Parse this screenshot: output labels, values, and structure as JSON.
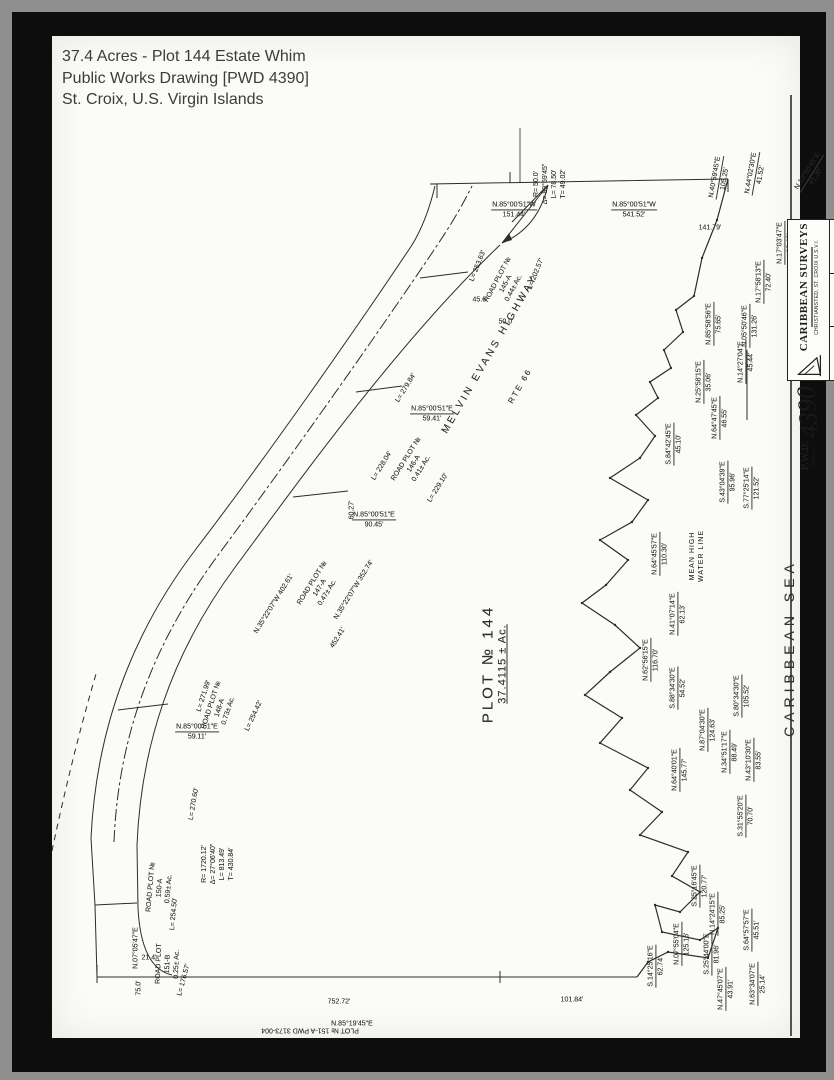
{
  "caption": {
    "line1": "37.4 Acres - Plot 144 Estate Whim",
    "line2": "Public Works Drawing [PWD 4390]",
    "line3": "St. Croix, U.S. Virgin Islands"
  },
  "plot": {
    "name": "PLOT № 144",
    "area": "37.4115 ± Ac."
  },
  "sea_label": "CARIBBEAN SEA",
  "highway": {
    "name": "MELVIN EVANS HIGHWAY",
    "route": "RTE 66"
  },
  "title_block": {
    "firm": "CARIBBEAN SURVEYS",
    "address": "CHRISTIANSTED, ST. CROIX  U.S.V.I.",
    "logo_icon": "sail-pennant-logo",
    "pwd": "P.W.D.",
    "dwg_no_label": "DWG. NO.",
    "dwg_no": "4390"
  },
  "labels": [
    {
      "t": [
        "N.85°00'51\"W",
        "151.44'"
      ],
      "x": 462,
      "y": 174,
      "r": 0,
      "u": 1
    },
    {
      "t": [
        "N.85°00'51\"W",
        "541.52'"
      ],
      "x": 582,
      "y": 174,
      "r": 0,
      "u": 1
    },
    {
      "t": [
        "141.79'"
      ],
      "x": 658,
      "y": 192,
      "r": 0
    },
    {
      "t": [
        "R= 50.0'",
        "Δ= 89°59'45\"",
        "L= 78.50'",
        "T= 49.02'"
      ],
      "x": 498,
      "y": 148,
      "r": -90
    },
    {
      "t": [
        "R= 1720.12'",
        "Δ= 27°06'40\"",
        "L= 813.49'",
        "T= 430.84'"
      ],
      "x": 166,
      "y": 828,
      "r": -90
    },
    {
      "t": [
        "N.10°50'45\"E",
        "41.30'"
      ],
      "x": 760,
      "y": 138,
      "r": -58,
      "u": 1
    },
    {
      "t": [
        "N.44°02'30\"E",
        "41.52'"
      ],
      "x": 704,
      "y": 138,
      "r": -80,
      "u": 1
    },
    {
      "t": [
        "N.40°59'45\"E",
        "105.25'"
      ],
      "x": 668,
      "y": 142,
      "r": -80,
      "u": 1
    },
    {
      "t": [
        "N.17°03'47\"E",
        "12.40'"
      ],
      "x": 733,
      "y": 207,
      "r": -90,
      "u": 1
    },
    {
      "t": [
        "N.17°58'13\"E",
        "72.40'"
      ],
      "x": 712,
      "y": 246,
      "r": -90,
      "u": 1
    },
    {
      "t": [
        "N.05°50'46\"E",
        "131.26'"
      ],
      "x": 698,
      "y": 290,
      "r": -90,
      "u": 1
    },
    {
      "t": [
        "N.85°58'56\"E",
        "75.65'"
      ],
      "x": 662,
      "y": 288,
      "r": -90,
      "u": 1
    },
    {
      "t": [
        "N.14°27'04\"E",
        "45.44'"
      ],
      "x": 694,
      "y": 326,
      "r": -90,
      "u": 1
    },
    {
      "t": [
        "N.25°58'15\"E",
        "35.06'"
      ],
      "x": 652,
      "y": 346,
      "r": -90,
      "u": 1
    },
    {
      "t": [
        "N.64°47'45\"E",
        "46.55'"
      ],
      "x": 668,
      "y": 382,
      "r": -90,
      "u": 1
    },
    {
      "t": [
        "S.84°42'45\"E",
        "45.10'"
      ],
      "x": 622,
      "y": 408,
      "r": -90,
      "u": 1
    },
    {
      "t": [
        "S.43°04'39\"E",
        "95.96'"
      ],
      "x": 676,
      "y": 446,
      "r": -90,
      "u": 1
    },
    {
      "t": [
        "S.77°25'14\"E",
        "121.52'"
      ],
      "x": 700,
      "y": 452,
      "r": -90,
      "u": 1
    },
    {
      "t": [
        "N.64°45'57\"E",
        "110.30'"
      ],
      "x": 608,
      "y": 518,
      "r": -90,
      "u": 1
    },
    {
      "t": [
        "MEAN HIGH",
        "WATER LINE"
      ],
      "x": 645,
      "y": 520,
      "r": -90,
      "ws": 1
    },
    {
      "t": [
        "N.41°07'14\"E",
        "62.13'"
      ],
      "x": 626,
      "y": 578,
      "r": -90,
      "u": 1
    },
    {
      "t": [
        "N.62°56'15\"E",
        "116.70'"
      ],
      "x": 599,
      "y": 624,
      "r": -90,
      "u": 1
    },
    {
      "t": [
        "S.88°34'30\"E",
        "54.52'"
      ],
      "x": 626,
      "y": 652,
      "r": -90,
      "u": 1
    },
    {
      "t": [
        "S.80°34'30\"E",
        "105.52'"
      ],
      "x": 690,
      "y": 660,
      "r": -90,
      "u": 1
    },
    {
      "t": [
        "N.87°04'30\"E",
        "124.63'"
      ],
      "x": 656,
      "y": 694,
      "r": -90,
      "u": 1
    },
    {
      "t": [
        "N.34°51'17\"E",
        "88.49'"
      ],
      "x": 678,
      "y": 716,
      "r": -90,
      "u": 1
    },
    {
      "t": [
        "N.64°40'01\"E",
        "145.77'"
      ],
      "x": 628,
      "y": 734,
      "r": -90,
      "u": 1
    },
    {
      "t": [
        "N.43°10'30\"E",
        "83.55'"
      ],
      "x": 702,
      "y": 724,
      "r": -90,
      "u": 1
    },
    {
      "t": [
        "S.31°55'20\"E",
        "70.70'"
      ],
      "x": 694,
      "y": 780,
      "r": -90,
      "u": 1
    },
    {
      "t": [
        "S.25°16'45\"E",
        "120.77'"
      ],
      "x": 648,
      "y": 850,
      "r": -90,
      "u": 1
    },
    {
      "t": [
        "N.14°24'15\"E",
        "85.25'"
      ],
      "x": 666,
      "y": 878,
      "r": -90,
      "u": 1
    },
    {
      "t": [
        "S.64°57'57\"E",
        "45.51'"
      ],
      "x": 700,
      "y": 894,
      "r": -90,
      "u": 1
    },
    {
      "t": [
        "S.25°44'00\"E",
        "81.96'"
      ],
      "x": 660,
      "y": 918,
      "r": -90,
      "u": 1
    },
    {
      "t": [
        "N.07°55'04\"E",
        "125.16'"
      ],
      "x": 630,
      "y": 908,
      "r": -90,
      "u": 1
    },
    {
      "t": [
        "S.14°25'16\"E",
        "62.74'"
      ],
      "x": 604,
      "y": 930,
      "r": -90,
      "u": 1
    },
    {
      "t": [
        "N.63°34'07\"E",
        "25.14'"
      ],
      "x": 706,
      "y": 948,
      "r": -90,
      "u": 1
    },
    {
      "t": [
        "N.47°45'07\"E",
        "43.91'"
      ],
      "x": 674,
      "y": 953,
      "r": -90,
      "u": 1
    },
    {
      "t": [
        "45.6'"
      ],
      "x": 428,
      "y": 264,
      "r": 0
    },
    {
      "t": [
        "50.0'"
      ],
      "x": 454,
      "y": 286,
      "r": 0
    },
    {
      "t": [
        "N.85°00'51\"E",
        "59.41'"
      ],
      "x": 380,
      "y": 378,
      "r": 0,
      "u": 1
    },
    {
      "t": [
        "N.85°00'51\"E",
        "90.45'"
      ],
      "x": 322,
      "y": 484,
      "r": 0,
      "u": 1
    },
    {
      "t": [
        "N.85°00'51\"E",
        "59.11'"
      ],
      "x": 145,
      "y": 696,
      "r": 0,
      "u": 1
    },
    {
      "t": [
        "60.27'"
      ],
      "x": 300,
      "y": 474,
      "r": -90
    },
    {
      "t": [
        "N.35°22'07\"W  402.61'"
      ],
      "x": 222,
      "y": 568,
      "r": -58
    },
    {
      "t": [
        "N.35°22'07\"W  352.74'"
      ],
      "x": 302,
      "y": 554,
      "r": -58
    },
    {
      "t": [
        "452.41'"
      ],
      "x": 286,
      "y": 602,
      "r": -58
    },
    {
      "t": [
        "L= 253.63'"
      ],
      "x": 426,
      "y": 230,
      "r": -68
    },
    {
      "t": [
        "L= 202.57'"
      ],
      "x": 484,
      "y": 238,
      "r": -68
    },
    {
      "t": [
        "L= 279.84'"
      ],
      "x": 354,
      "y": 352,
      "r": -58
    },
    {
      "t": [
        "L= 228.04'"
      ],
      "x": 330,
      "y": 430,
      "r": -58
    },
    {
      "t": [
        "L= 229.10'"
      ],
      "x": 386,
      "y": 452,
      "r": -58
    },
    {
      "t": [
        "L= 271.99'"
      ],
      "x": 152,
      "y": 660,
      "r": -72
    },
    {
      "t": [
        "L= 254.42'"
      ],
      "x": 202,
      "y": 680,
      "r": -65
    },
    {
      "t": [
        "L= 270.60'"
      ],
      "x": 142,
      "y": 768,
      "r": -80
    },
    {
      "t": [
        "L= 254.50'"
      ],
      "x": 122,
      "y": 878,
      "r": -85
    },
    {
      "t": [
        "L= 176.57'"
      ],
      "x": 132,
      "y": 944,
      "r": -75
    },
    {
      "t": [
        "ROAD PLOT №",
        "145-A",
        "0.44± Ac."
      ],
      "x": 454,
      "y": 248,
      "r": -62
    },
    {
      "t": [
        "ROAD PLOT №",
        "146-A",
        "0.41± Ac."
      ],
      "x": 362,
      "y": 428,
      "r": -58
    },
    {
      "t": [
        "ROAD PLOT №",
        "147-A",
        "0.47± Ac."
      ],
      "x": 268,
      "y": 552,
      "r": -58
    },
    {
      "t": [
        "ROAD PLOT №",
        "148-A",
        "0.73± Ac."
      ],
      "x": 168,
      "y": 672,
      "r": -72
    },
    {
      "t": [
        "ROAD PLOT №",
        "150-A",
        "0.59± Ac."
      ],
      "x": 108,
      "y": 852,
      "r": -85
    },
    {
      "t": [
        "ROAD PLOT",
        "151-B",
        "0.25± Ac."
      ],
      "x": 116,
      "y": 928,
      "r": -88
    },
    {
      "t": [
        "N.07°05'47\"E"
      ],
      "x": 84,
      "y": 912,
      "r": -90
    },
    {
      "t": [
        "21.4'"
      ],
      "x": 97,
      "y": 922,
      "r": 0
    },
    {
      "t": [
        "75.0'"
      ],
      "x": 87,
      "y": 952,
      "r": -90
    },
    {
      "t": [
        "752.72'"
      ],
      "x": 287,
      "y": 966,
      "r": 0
    },
    {
      "t": [
        "N.85°19'45\"E"
      ],
      "x": 300,
      "y": 988,
      "r": 0
    },
    {
      "t": [
        "101.84'"
      ],
      "x": 520,
      "y": 964,
      "r": 0
    },
    {
      "t": [
        "PLOT № 151-A   PWD 3173-004"
      ],
      "x": 258,
      "y": 994,
      "r": 180
    }
  ]
}
